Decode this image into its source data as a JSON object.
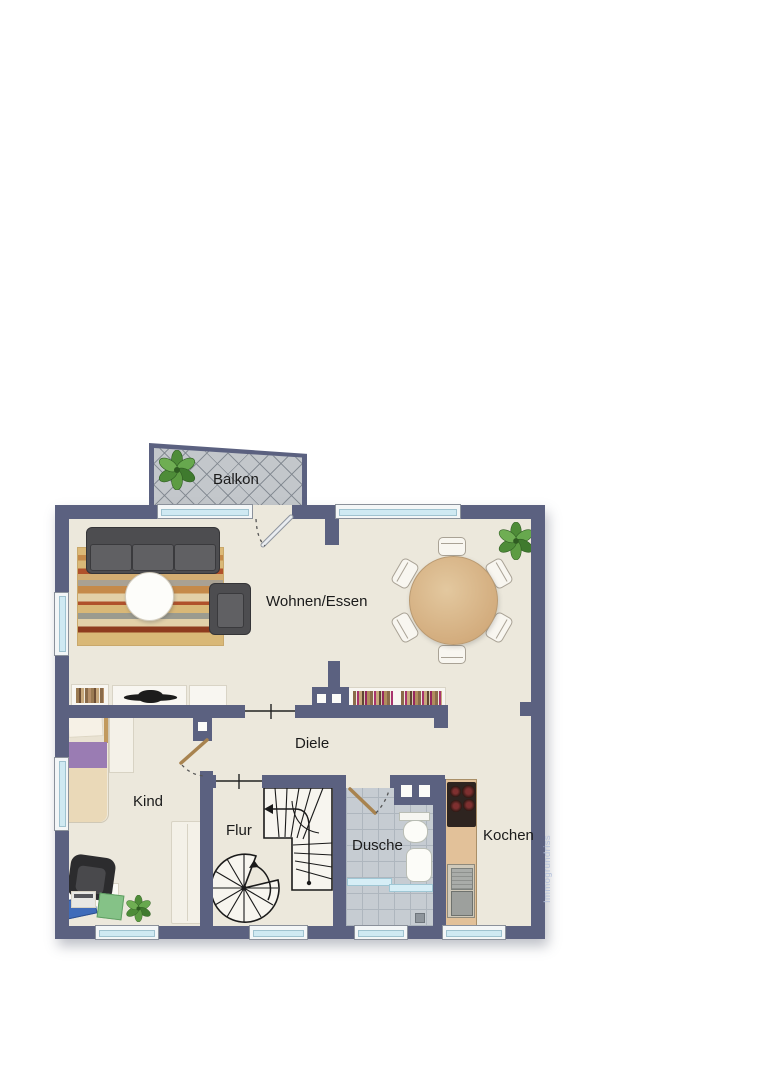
{
  "plan": {
    "watermark": "Immogrundriss",
    "rooms": {
      "balkon": "Balkon",
      "wohnen_essen": "Wohnen/Essen",
      "diele": "Diele",
      "kind": "Kind",
      "flur": "Flur",
      "dusche": "Dusche",
      "kochen": "Kochen"
    },
    "colors": {
      "wall": "#5b6180",
      "floor": "#ece8dc",
      "balcony_tiles": "#c3c7cb",
      "shower_tiles": "#c6ccd2",
      "window_glass": "#cfe9f2",
      "door_leaf": "#a8834f",
      "sofa": "#4d4d50",
      "dining_table_wood": "#d2ab7c",
      "kitchen_counter": "#e2c199",
      "bed_purple": "#9a7cb3",
      "plant_green": "#4e8c38",
      "watermark_text": "#b6c2dc",
      "label_text": "#1b1b1b"
    }
  }
}
